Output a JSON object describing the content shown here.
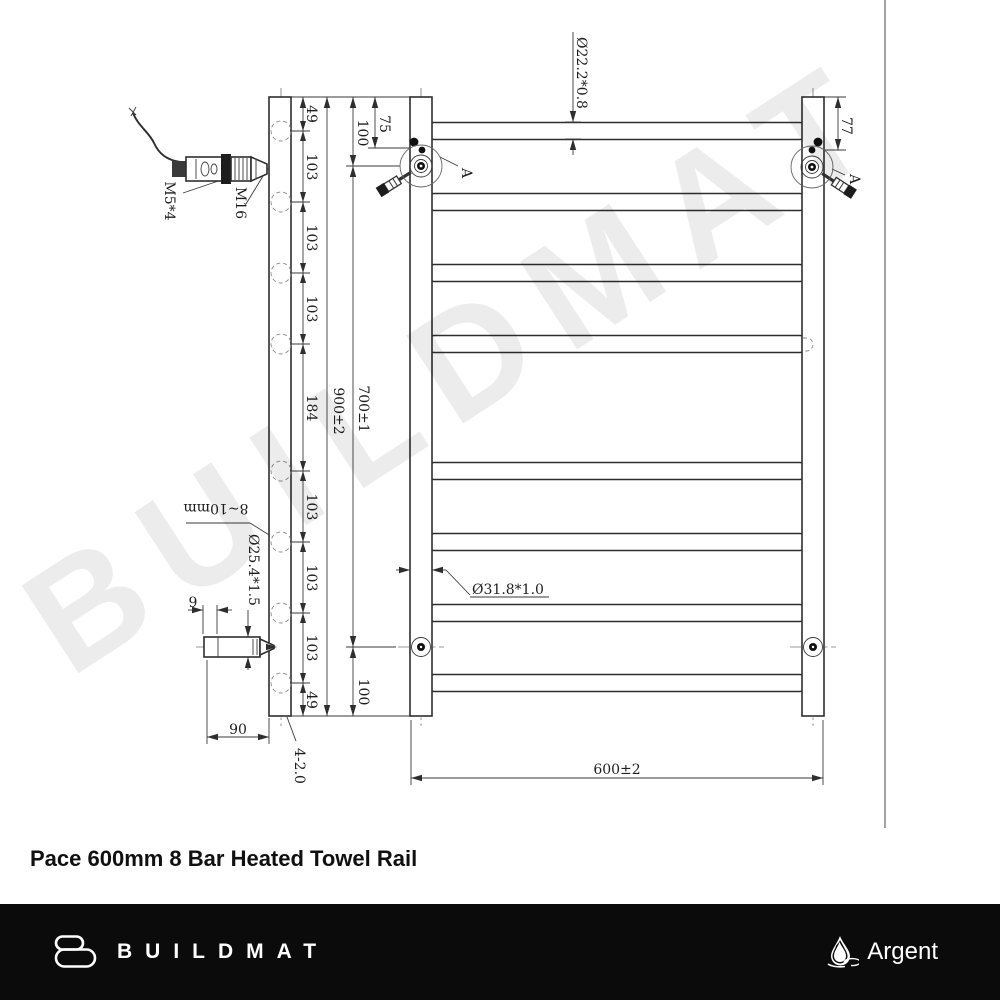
{
  "title": "Pace 600mm 8 Bar Heated Towel Rail",
  "watermark": "BUILDMAT",
  "colors": {
    "footer_bg": "#0b0b0b",
    "line": "#2e2e2e",
    "watermark_gray": "#e9e9e9",
    "footer_text": "#ffffff"
  },
  "footer": {
    "brand": "BUILDMAT",
    "brand_right": "Argent",
    "brand_icon": "towel-b-icon",
    "brand_right_icon": "water-drop-icon"
  },
  "drawing": {
    "side_view": {
      "chain": [
        "49",
        "103",
        "103",
        "103",
        "184",
        "103",
        "103",
        "103",
        "49"
      ],
      "overall_height": "900±2",
      "wall_gap_note": "8~10mm",
      "bracket_diameter": "Ø25.4*1.5",
      "wall_thickness": "9",
      "bracket_depth": "90",
      "corner_note": "4-2.0",
      "element_thread": "M5*4",
      "gland_thread": "M16"
    },
    "front_view": {
      "width": "600±2",
      "mount_span": "700±1",
      "top_offset": "100",
      "bottom_offset": "100",
      "switch_offset": "75",
      "right_offset": "77",
      "bar_diameter": "Ø22.2*0.8",
      "rail_diameter": "Ø31.8*1.0",
      "detail_label": "A"
    }
  }
}
